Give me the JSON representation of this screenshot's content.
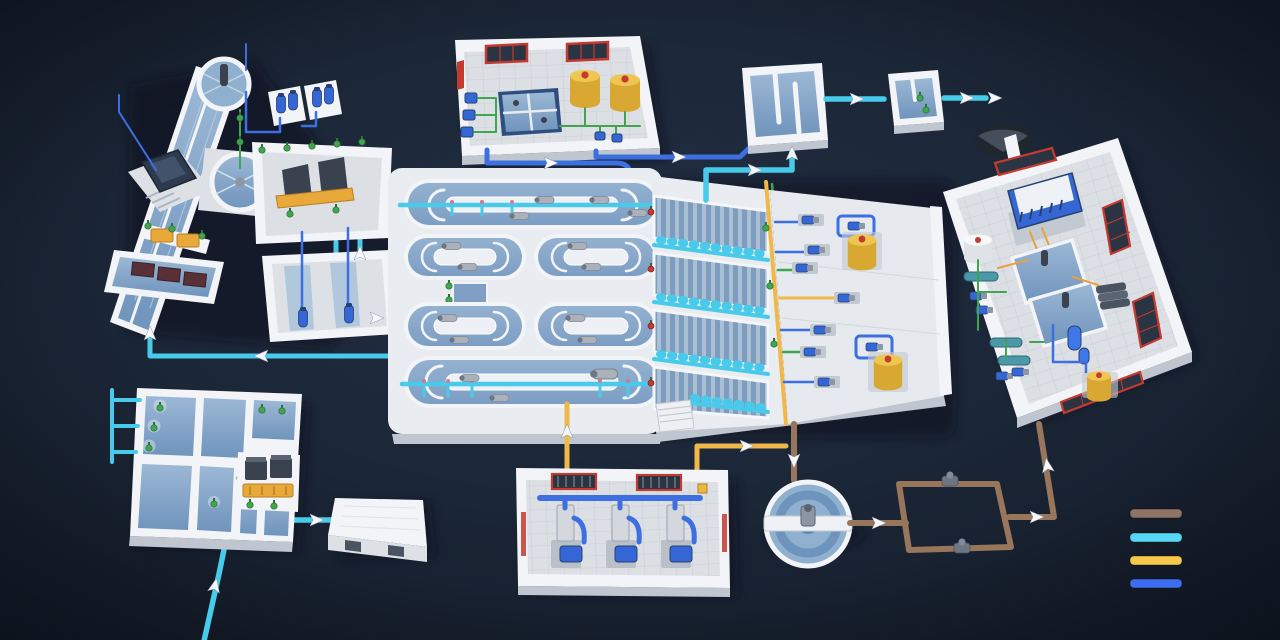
{
  "meta": {
    "kind": "isometric-process-illustration",
    "subject": "wastewater-treatment-plant"
  },
  "palette": {
    "background": "#1b2636",
    "background_edge": "#131b28",
    "wall": "#f2f4f7",
    "wall_shade": "#dde1e6",
    "wall_side": "#bfc6cf",
    "floor": "#dcdfe4",
    "floor_line": "#c7cbd2",
    "water": "#7fa0c4",
    "water_light": "#a6c0da",
    "pipe_cyan": "#48cbea",
    "pipe_blue": "#3d6fe0",
    "pipe_yellow": "#f0b848",
    "pipe_brown": "#97765c",
    "pipe_green": "#3fa54e",
    "pump_blue": "#3566d6",
    "pump_dark": "#27416f",
    "equip_dark": "#39424e",
    "equip_gray": "#a7aeb8",
    "tank_yellow": "#e9ba3f",
    "red": "#c23a30",
    "window_dark": "#2a3442",
    "arrow": "#f5f7fa"
  },
  "legend": {
    "items": [
      {
        "name": "sludge-line",
        "color": "#8f7366"
      },
      {
        "name": "water-line",
        "color": "#55d7f5"
      },
      {
        "name": "air-line",
        "color": "#f7c94b"
      },
      {
        "name": "chemical-line",
        "color": "#3e6cee"
      }
    ]
  },
  "scene": {
    "units": [
      "intake-screening-facility",
      "chemical-dosing-building",
      "contact-tank",
      "sampling-tank",
      "oxidation-ditch-platform",
      "lamella-settler-platform",
      "pump-gallery",
      "sludge-dewatering-building",
      "pretreatment-basin-complex",
      "pump-station-building",
      "blower-building",
      "gravity-thickener",
      "sludge-pump-loop",
      "flow-arrows",
      "pipe-legend"
    ]
  }
}
